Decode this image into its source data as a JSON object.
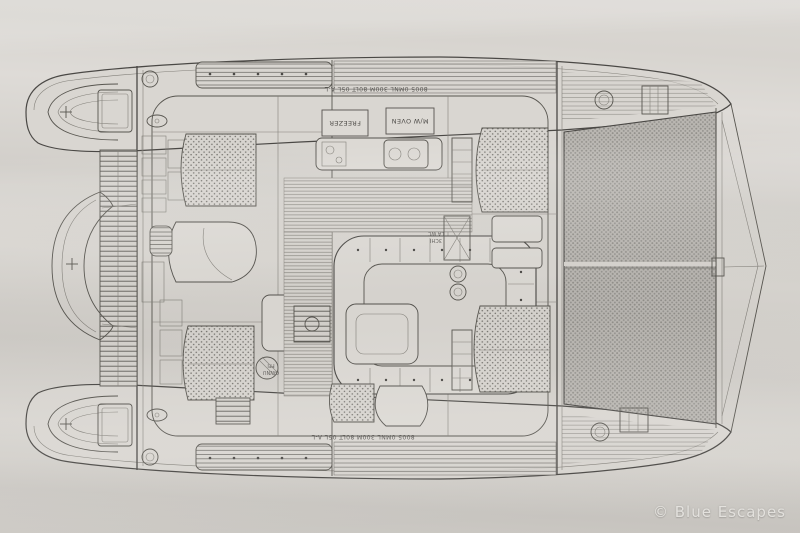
{
  "document": {
    "kind_label": "catamaran deck plan scan"
  },
  "annotations": {
    "top_note": "8005 0MNL 300M 80LT 05L A-L",
    "bottom_note": "8005 0MNL 300M 80LT 05L A-L",
    "freezer": "FREEZER",
    "microwave": "M/W OVEN",
    "mast_line1": "3CHI",
    "mast_line2": "LA WC",
    "locker_line1": "GWNU",
    "locker_line2": "FFI"
  },
  "watermark": {
    "text": "© Blue Escapes"
  },
  "colors": {
    "paper": "#d6d3ce",
    "ink": "#4a4845",
    "mesh": "#b4b1ac",
    "watermark": "#eceae6"
  }
}
